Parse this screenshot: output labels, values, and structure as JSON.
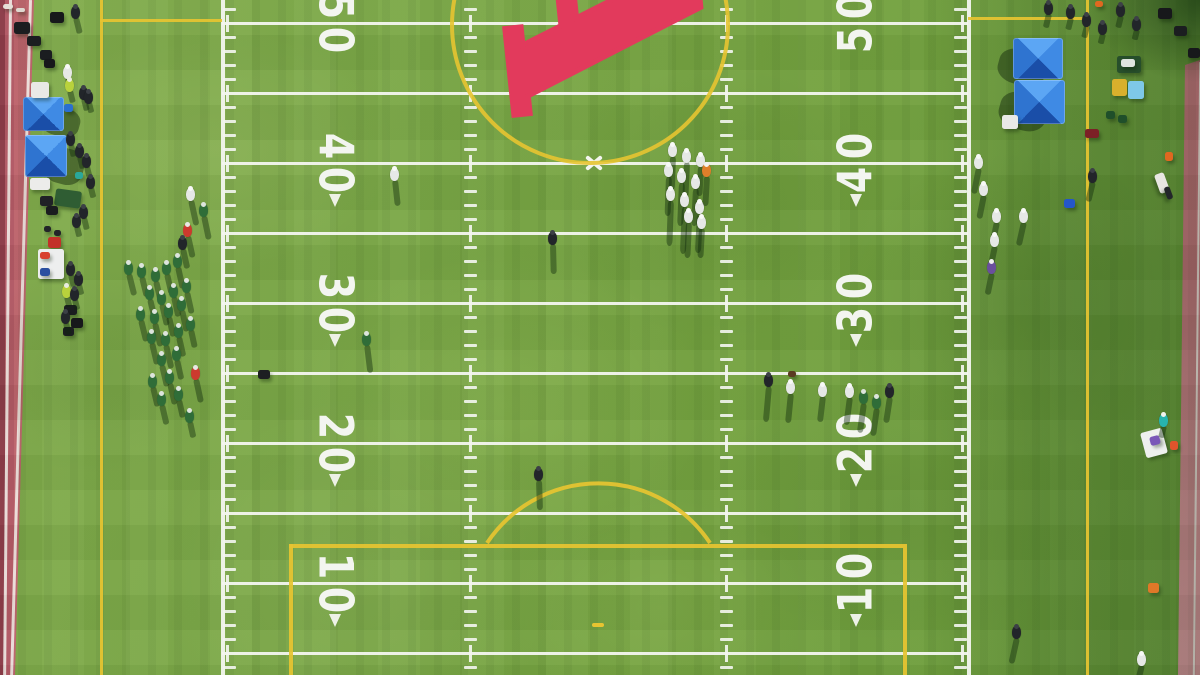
{
  "scene": {
    "width": 1200,
    "height": 675,
    "description": "Aerial top-down drone photo of a football field: white yard lines and numbers, yellow soccer markings, crimson midfield letter logo, players, sideline crowds, blue canopy tents, pink running track at left and right edges"
  },
  "palette": {
    "grass": "#76a443",
    "grass_dark": "#5f9136",
    "line_white": "#f3f5ef",
    "marking_yellow": "#e7c431",
    "logo_red": "#e23a5c",
    "track_pink": "#c2666f",
    "track_dark_maroon": "#8e3c4a",
    "tent_blue": "#2f74d0",
    "shadow": "rgba(15,40,12,0.42)"
  },
  "football": {
    "sideline_left_x": 222,
    "sideline_right_x": 968,
    "yard_line_start_y": 23,
    "yard_line_spacing": 70,
    "yard_line_count": 10,
    "yard_line_thickness": 3,
    "hash_columns": [
      464,
      720
    ],
    "side_tick_left_x": 223,
    "side_tick_right_x": 954,
    "tick_spacing": 14,
    "tick_len": 13,
    "cross_tick_xs": [
      227,
      470,
      726,
      962
    ],
    "numbers": {
      "labels": [
        "50",
        "40",
        "30",
        "20",
        "10"
      ],
      "line_indices": [
        0,
        2,
        4,
        6,
        8
      ],
      "left_x": 335,
      "right_x": 856,
      "arrows_for": [
        "40",
        "30",
        "20",
        "10"
      ],
      "color": "#f3f5f0"
    },
    "center_mark": {
      "x": 594,
      "y": 163
    }
  },
  "soccer": {
    "touchline_left_x": 100,
    "touchline_right_x": 1086,
    "halfway_y": 19,
    "center_circle": {
      "cx": 590,
      "cy": 25,
      "r": 140
    },
    "penalty_box": {
      "left_x": 289,
      "right_x": 903,
      "top_y": 544
    },
    "penalty_arc": {
      "x1": 487,
      "y1": 543,
      "x2": 710,
      "y2": 543,
      "r": 134
    },
    "penalty_spot": {
      "x": 592,
      "y": 623,
      "w": 12,
      "h": 4
    },
    "line_thickness": 4
  },
  "logo": {
    "letter": "A"
  },
  "tents_format": "[x, y, width, height]",
  "tents": [
    [
      23,
      97,
      41,
      34
    ],
    [
      25,
      135,
      42,
      42
    ],
    [
      1013,
      38,
      50,
      41
    ],
    [
      1014,
      80,
      51,
      44
    ]
  ],
  "objects_format": "[x, y, width, height, color, rotation_deg]",
  "objects": [
    [
      14,
      22,
      16,
      12,
      "#1b1d20",
      0
    ],
    [
      27,
      36,
      14,
      10,
      "#1b1d20",
      0
    ],
    [
      50,
      12,
      14,
      11,
      "#17181b",
      0
    ],
    [
      40,
      50,
      12,
      10,
      "#1b1d20",
      0
    ],
    [
      44,
      59,
      11,
      9,
      "#17181b",
      0
    ],
    [
      3,
      4,
      10,
      5,
      "#e6e0d8",
      0
    ],
    [
      16,
      8,
      9,
      4,
      "#ded8d0",
      0
    ],
    [
      31,
      82,
      18,
      16,
      "#e9e9e6",
      0
    ],
    [
      64,
      104,
      9,
      8,
      "#2a6fd0",
      0
    ],
    [
      30,
      178,
      20,
      12,
      "#ececea",
      0
    ],
    [
      75,
      172,
      8,
      7,
      "#2aa79b",
      0
    ],
    [
      55,
      190,
      26,
      17,
      "#2f5d33",
      8
    ],
    [
      40,
      196,
      13,
      10,
      "#202226",
      0
    ],
    [
      46,
      206,
      12,
      9,
      "#1a1c1f",
      0
    ],
    [
      44,
      226,
      7,
      6,
      "#222428",
      0
    ],
    [
      54,
      230,
      7,
      6,
      "#222428",
      0
    ],
    [
      48,
      237,
      13,
      11,
      "#c23128",
      0
    ],
    [
      38,
      249,
      26,
      30,
      "#edeeee",
      0
    ],
    [
      40,
      252,
      10,
      7,
      "#d8402f",
      0
    ],
    [
      40,
      268,
      10,
      8,
      "#2b4fa0",
      0
    ],
    [
      64,
      305,
      13,
      10,
      "#1b1d20",
      0
    ],
    [
      71,
      318,
      12,
      10,
      "#17181b",
      0
    ],
    [
      63,
      327,
      11,
      9,
      "#1b1d20",
      0
    ],
    [
      258,
      370,
      12,
      9,
      "#1d1f22",
      0
    ],
    [
      788,
      371,
      8,
      6,
      "#5a3b22",
      0
    ],
    [
      1117,
      56,
      24,
      17,
      "#274e2b",
      0
    ],
    [
      1121,
      59,
      14,
      8,
      "#dfe4df",
      0
    ],
    [
      1112,
      79,
      15,
      17,
      "#d8b02c",
      0
    ],
    [
      1128,
      81,
      16,
      18,
      "#7ec8e8",
      0
    ],
    [
      1002,
      115,
      16,
      14,
      "#e8e9e6",
      0
    ],
    [
      1085,
      129,
      14,
      9,
      "#7c2026",
      0
    ],
    [
      1106,
      111,
      9,
      8,
      "#1f4f2a",
      0
    ],
    [
      1118,
      115,
      9,
      8,
      "#1f4f2a",
      0
    ],
    [
      1064,
      199,
      11,
      9,
      "#2456c8",
      0
    ],
    [
      1165,
      152,
      8,
      9,
      "#e06820",
      0
    ],
    [
      1095,
      1,
      8,
      6,
      "#e06820",
      0
    ],
    [
      1148,
      583,
      11,
      10,
      "#e07828",
      0
    ],
    [
      1143,
      430,
      22,
      26,
      "#eef0ee",
      -15
    ],
    [
      1150,
      436,
      10,
      9,
      "#7a57b8",
      -15
    ],
    [
      1170,
      441,
      8,
      9,
      "#e0542c",
      0
    ],
    [
      1152,
      178,
      20,
      10,
      "#e8e6e2",
      70
    ],
    [
      1162,
      190,
      13,
      6,
      "#23262a",
      70
    ],
    [
      1158,
      8,
      14,
      11,
      "#17181b",
      0
    ],
    [
      1174,
      26,
      13,
      10,
      "#1b1d20",
      0
    ],
    [
      1188,
      48,
      12,
      10,
      "#17181b",
      0
    ]
  ],
  "figure_styles": {
    "white": {
      "body": "#e6e8e6",
      "head": "#f8f9f7"
    },
    "green": {
      "body": "#2f6d38",
      "head": "#dde4dd"
    },
    "dark": {
      "body": "#22252a",
      "head": "#3c4046"
    },
    "red": {
      "body": "#cc3a2e",
      "head": "#e8e8e4"
    },
    "orange": {
      "body": "#df7f2a",
      "head": "#f3f3ef"
    },
    "purple": {
      "body": "#6a4f9c",
      "head": "#efefef"
    },
    "teal": {
      "body": "#27b3ae",
      "head": "#f2f2ee"
    },
    "lime": {
      "body": "#b9d23c",
      "head": "#e9ecdf"
    }
  },
  "figures_format": "[x, y, kind, shadow_length]",
  "figures": [
    [
      672,
      150,
      "white",
      34
    ],
    [
      686,
      156,
      "white",
      36
    ],
    [
      700,
      160,
      "white",
      30
    ],
    [
      668,
      170,
      "white",
      40
    ],
    [
      681,
      176,
      "white",
      44
    ],
    [
      695,
      182,
      "white",
      38
    ],
    [
      670,
      194,
      "white",
      46
    ],
    [
      684,
      200,
      "white",
      48
    ],
    [
      699,
      207,
      "white",
      40
    ],
    [
      706,
      170,
      "orange",
      30
    ],
    [
      688,
      216,
      "white",
      36
    ],
    [
      701,
      222,
      "white",
      30
    ],
    [
      394,
      174,
      "white",
      26
    ],
    [
      552,
      238,
      "dark",
      30
    ],
    [
      366,
      339,
      "green",
      28
    ],
    [
      538,
      474,
      "dark",
      30
    ],
    [
      768,
      380,
      "dark",
      36
    ],
    [
      790,
      387,
      "white",
      30
    ],
    [
      822,
      390,
      "white",
      26
    ],
    [
      849,
      391,
      "white",
      28
    ],
    [
      863,
      397,
      "green",
      30
    ],
    [
      876,
      402,
      "green",
      28
    ],
    [
      889,
      391,
      "dark",
      26
    ],
    [
      978,
      162,
      "white",
      26
    ],
    [
      983,
      189,
      "white",
      24
    ],
    [
      996,
      216,
      "white",
      22
    ],
    [
      1023,
      216,
      "white",
      24
    ],
    [
      994,
      240,
      "white",
      22
    ],
    [
      991,
      267,
      "purple",
      22
    ],
    [
      1092,
      176,
      "dark",
      20
    ],
    [
      1016,
      632,
      "dark",
      26
    ],
    [
      1141,
      659,
      "white",
      16
    ],
    [
      1163,
      420,
      "teal",
      12
    ],
    [
      190,
      194,
      "white",
      26
    ],
    [
      203,
      210,
      "green",
      24
    ],
    [
      187,
      230,
      "red",
      22
    ],
    [
      182,
      243,
      "dark",
      20
    ],
    [
      128,
      268,
      "green",
      22
    ],
    [
      141,
      271,
      "green",
      20
    ],
    [
      155,
      275,
      "green",
      22
    ],
    [
      166,
      268,
      "green",
      20
    ],
    [
      177,
      261,
      "green",
      22
    ],
    [
      149,
      293,
      "green",
      24
    ],
    [
      161,
      298,
      "green",
      22
    ],
    [
      173,
      291,
      "green",
      20
    ],
    [
      186,
      286,
      "green",
      22
    ],
    [
      140,
      314,
      "green",
      22
    ],
    [
      154,
      317,
      "green",
      24
    ],
    [
      168,
      311,
      "green",
      20
    ],
    [
      181,
      304,
      "green",
      22
    ],
    [
      151,
      337,
      "green",
      22
    ],
    [
      165,
      339,
      "green",
      24
    ],
    [
      178,
      331,
      "green",
      20
    ],
    [
      190,
      324,
      "green",
      18
    ],
    [
      161,
      359,
      "green",
      22
    ],
    [
      176,
      354,
      "green",
      20
    ],
    [
      195,
      373,
      "red",
      24
    ],
    [
      152,
      381,
      "green",
      20
    ],
    [
      169,
      377,
      "green",
      22
    ],
    [
      161,
      399,
      "green",
      20
    ],
    [
      178,
      394,
      "green",
      18
    ],
    [
      189,
      416,
      "green",
      16
    ],
    [
      75,
      12,
      "dark",
      16
    ],
    [
      67,
      72,
      "white",
      12
    ],
    [
      69,
      85,
      "lime",
      12
    ],
    [
      83,
      93,
      "dark",
      12
    ],
    [
      88,
      97,
      "dark",
      10
    ],
    [
      70,
      139,
      "dark",
      12
    ],
    [
      79,
      151,
      "dark",
      12
    ],
    [
      86,
      161,
      "dark",
      10
    ],
    [
      90,
      182,
      "dark",
      10
    ],
    [
      83,
      212,
      "dark",
      12
    ],
    [
      76,
      221,
      "dark",
      10
    ],
    [
      70,
      269,
      "dark",
      12
    ],
    [
      78,
      279,
      "dark",
      10
    ],
    [
      66,
      291,
      "lime",
      10
    ],
    [
      74,
      294,
      "dark",
      10
    ],
    [
      65,
      317,
      "dark",
      12
    ],
    [
      1048,
      8,
      "dark",
      14
    ],
    [
      1070,
      12,
      "dark",
      12
    ],
    [
      1086,
      20,
      "dark",
      12
    ],
    [
      1102,
      28,
      "dark",
      10
    ],
    [
      1120,
      10,
      "dark",
      12
    ],
    [
      1136,
      24,
      "dark",
      10
    ]
  ]
}
